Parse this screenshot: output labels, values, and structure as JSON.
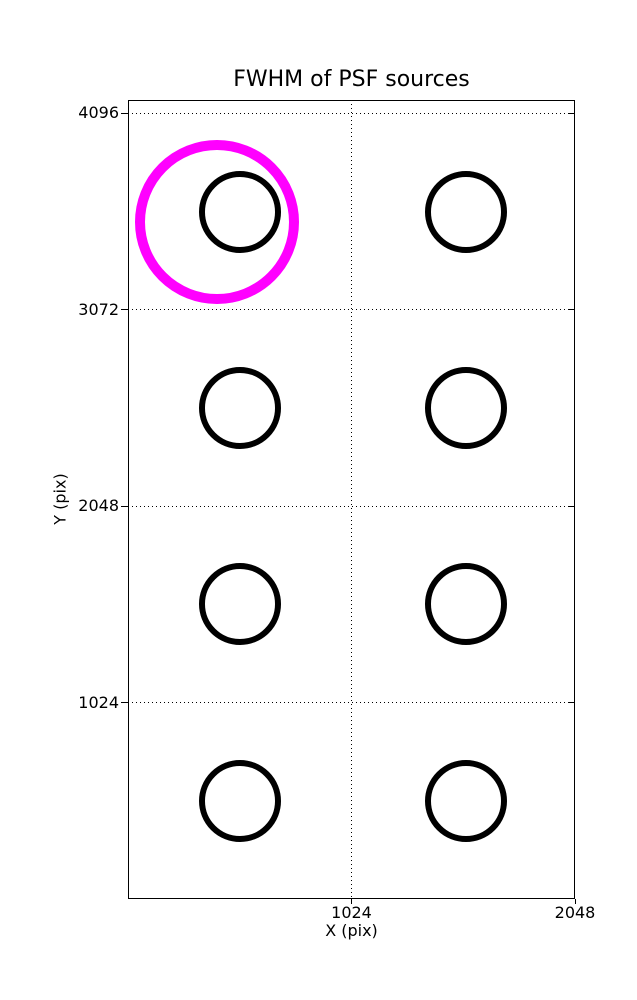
{
  "chart_data": {
    "type": "scatter",
    "title": "FWHM of PSF sources",
    "xlabel": "X (pix)",
    "ylabel": "Y (pix)",
    "xlim": [
      0,
      2048
    ],
    "ylim": [
      0,
      4166
    ],
    "xticks": [
      {
        "value": 1024,
        "label": "1024"
      },
      {
        "value": 2048,
        "label": "2048"
      }
    ],
    "yticks": [
      {
        "value": 1024,
        "label": "1024"
      },
      {
        "value": 2048,
        "label": "2048"
      },
      {
        "value": 3072,
        "label": "3072"
      },
      {
        "value": 4096,
        "label": "4096"
      }
    ],
    "grid": {
      "visible": true,
      "linestyle": "dotted",
      "color": "#000000"
    },
    "legend": {
      "visible": false
    },
    "series": [
      {
        "name": "psf-sources",
        "marker": {
          "shape": "circle-outline",
          "color": "#000000",
          "radius_px": 38,
          "stroke_px": 6
        },
        "points": [
          {
            "x": 512,
            "y": 3584
          },
          {
            "x": 1550,
            "y": 3584
          },
          {
            "x": 512,
            "y": 2560
          },
          {
            "x": 1550,
            "y": 2560
          },
          {
            "x": 512,
            "y": 1536
          },
          {
            "x": 1550,
            "y": 1536
          },
          {
            "x": 512,
            "y": 512
          },
          {
            "x": 1550,
            "y": 512
          }
        ]
      },
      {
        "name": "highlighted-source",
        "marker": {
          "shape": "circle-outline",
          "color": "#ff00ff",
          "radius_px": 77,
          "stroke_px": 10
        },
        "points": [
          {
            "x": 406,
            "y": 3531
          }
        ]
      }
    ]
  }
}
